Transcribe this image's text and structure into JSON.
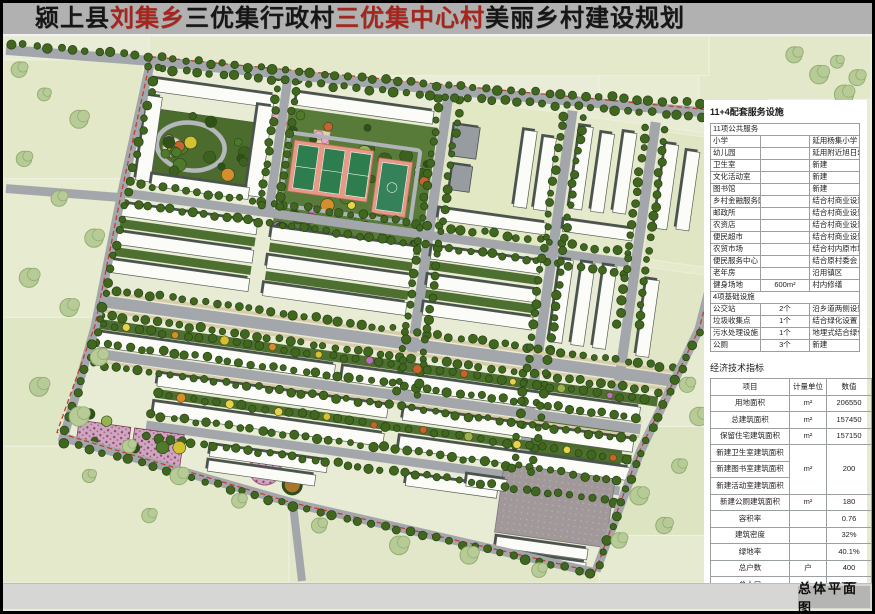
{
  "title": {
    "segments": [
      {
        "text": "颍上县",
        "color": "#161616"
      },
      {
        "text": "刘集乡",
        "color": "#a6251c"
      },
      {
        "text": "三优集行政村",
        "color": "#161616"
      },
      {
        "text": "三优集中心村",
        "color": "#a6251c"
      },
      {
        "text": "美丽乡村建设规划",
        "color": "#161616"
      }
    ]
  },
  "panel": {
    "heading": "11+4配套服务设施",
    "services": {
      "sections": [
        {
          "header": "11项公共服务",
          "rows": [
            {
              "name": "小学",
              "qty": "",
              "note": "延用杨集小学"
            },
            {
              "name": "幼儿园",
              "qty": "",
              "note": "延用附近旭日幼儿园"
            },
            {
              "name": "卫生室",
              "qty": "",
              "note": "新建"
            },
            {
              "name": "文化活动室",
              "qty": "",
              "note": "新建"
            },
            {
              "name": "图书馆",
              "qty": "",
              "note": "新建"
            },
            {
              "name": "乡村金融服务网点",
              "qty": "",
              "note": "结合村商业设置"
            },
            {
              "name": "邮政所",
              "qty": "",
              "note": "结合村商业设置"
            },
            {
              "name": "农资店",
              "qty": "",
              "note": "结合村商业设置"
            },
            {
              "name": "便民超市",
              "qty": "",
              "note": "结合村商业设置"
            },
            {
              "name": "农贸市场",
              "qty": "",
              "note": "结合村内原市场"
            },
            {
              "name": "便民服务中心",
              "qty": "",
              "note": "结合原村委会"
            },
            {
              "name": "老年房",
              "qty": "",
              "note": "沿用镇区"
            },
            {
              "name": "健身场地",
              "qty": "600m²",
              "note": "村内修缮"
            }
          ]
        },
        {
          "header": "4项基础设施",
          "rows": [
            {
              "name": "公交站",
              "qty": "2个",
              "note": "沿乡道两侧设置两处"
            },
            {
              "name": "垃圾收集点",
              "qty": "1个",
              "note": "结合绿化设置"
            },
            {
              "name": "污水处理设施",
              "qty": "1个",
              "note": "地埋式结合绿化设置"
            },
            {
              "name": "公厕",
              "qty": "3个",
              "note": "新建"
            }
          ]
        }
      ]
    },
    "economic": {
      "title": "经济技术指标",
      "headers": [
        "项目",
        "计量单位",
        "数值"
      ],
      "rows": [
        {
          "item": "用地面积",
          "unit": "m²",
          "value": "206550"
        },
        {
          "item": "总建筑面积",
          "unit": "m²",
          "value": "157450"
        },
        {
          "item": "保留住宅建筑面积",
          "unit": "m²",
          "value": "157150"
        },
        {
          "item": "新建卫生室建筑面积",
          "unit": "m²",
          "value": "200",
          "unit_rowspan": 3,
          "value_rowspan": 3
        },
        {
          "item": "新建图书室建筑面积",
          "skip_unit": true,
          "skip_value": true
        },
        {
          "item": "新建活动室建筑面积",
          "skip_unit": true,
          "skip_value": true
        },
        {
          "item": "新建公厕建筑面积",
          "unit": "m²",
          "value": "180"
        },
        {
          "item": "容积率",
          "unit": "",
          "value": "0.76"
        },
        {
          "item": "建筑密度",
          "unit": "",
          "value": "32%"
        },
        {
          "item": "绿地率",
          "unit": "",
          "value": "40.1%"
        },
        {
          "item": "总户数",
          "unit": "户",
          "value": "400"
        },
        {
          "item": "总人口",
          "unit": "人",
          "value": "1250"
        }
      ]
    }
  },
  "footer": {
    "label": "总体平面图"
  },
  "colors": {
    "title_bar": "#b1b1b1",
    "accent_red": "#a6251c",
    "footer_bar": "#d6d6d4",
    "footer_label_bg": "#b5b5b3",
    "road_gray": "#a3a7ab",
    "boundary_red": "#c2402a",
    "field_green": "#e9ecd6"
  }
}
